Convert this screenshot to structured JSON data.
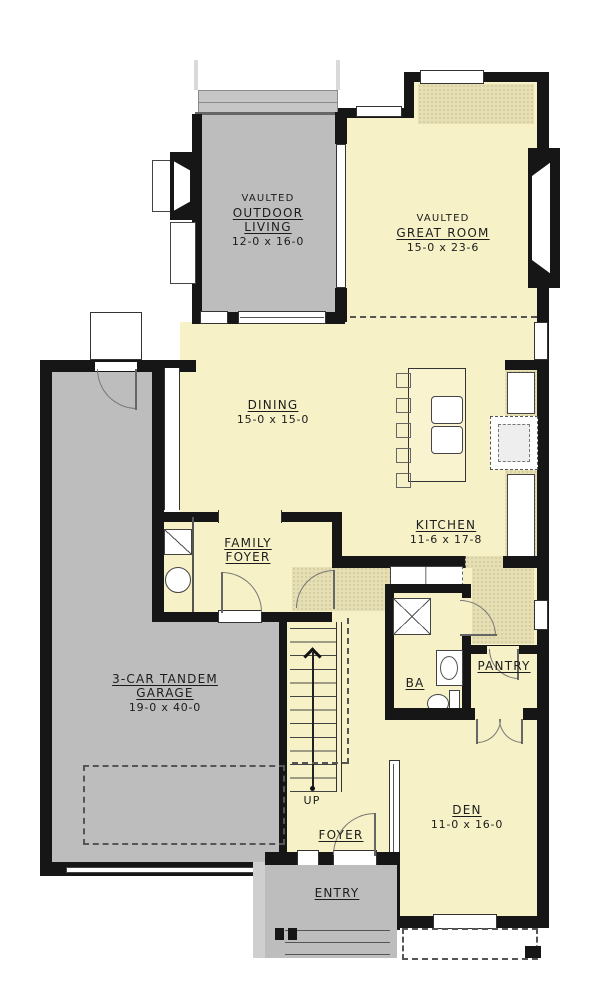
{
  "colors": {
    "floor_yellow": "#f6f1c6",
    "porch_gray": "#bdbdbd",
    "hatch_tan": "#e6dfb3",
    "wall_black": "#161616"
  },
  "labels": {
    "outdoor_living": {
      "vaulted": "VAULTED",
      "line1": "OUTDOOR",
      "line2": "LIVING",
      "dims": "12-0 x 16-0"
    },
    "great_room": {
      "vaulted": "VAULTED",
      "name": "GREAT ROOM",
      "dims": "15-0 x 23-6"
    },
    "dining": {
      "name": "DINING",
      "dims": "15-0 x 15-0"
    },
    "kitchen": {
      "name": "KITCHEN",
      "dims": "11-6 x 17-8"
    },
    "family_foyer": {
      "line1": "FAMILY",
      "line2": "FOYER"
    },
    "garage": {
      "line1": "3-CAR TANDEM",
      "line2": "GARAGE",
      "dims": "19-0 x 40-0"
    },
    "bath": {
      "name": "BA"
    },
    "pantry": {
      "name": "PANTRY"
    },
    "den": {
      "name": "DEN",
      "dims": "11-0 x 16-0"
    },
    "foyer": {
      "name": "FOYER"
    },
    "entry": {
      "name": "ENTRY"
    },
    "stairs": {
      "direction": "UP"
    }
  }
}
